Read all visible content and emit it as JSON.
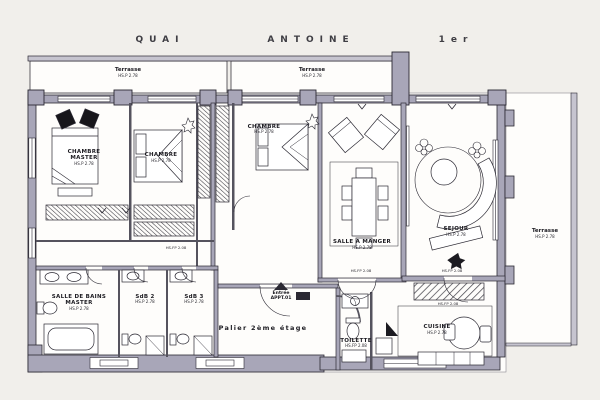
{
  "street": {
    "word1": "QUAI",
    "word2": "ANTOINE",
    "word3": "1er"
  },
  "rooms": {
    "terrasse_left": {
      "name": "Terrasse",
      "dim": "HS.P 2.78"
    },
    "terrasse_mid": {
      "name": "Terrasse",
      "dim": "HS.P 2.78"
    },
    "terrasse_right": {
      "name": "Terrasse",
      "dim": "HS.P 2.78"
    },
    "chambre_master": {
      "name_line1": "CHAMBRE",
      "name_line2": "MASTER",
      "dim": "HS.P 2.78"
    },
    "chambre_2": {
      "name": "CHAMBRE",
      "dim": "HS.P 2.78"
    },
    "chambre_3": {
      "name": "CHAMBRE",
      "dim": "HS.P 2.78"
    },
    "salle_a_manger": {
      "name": "SALLE A MANGER",
      "dim": "HS.P 2.78"
    },
    "sejour": {
      "name": "SEJOUR",
      "dim": "HS.P 2.78"
    },
    "salle_de_bains_master": {
      "name_line1": "SALLE DE BAINS",
      "name_line2": "MASTER",
      "dim": "HS.P 2.78"
    },
    "sdb_2": {
      "name": "SdB 2",
      "dim": "HS.P 2.78"
    },
    "sdb_3": {
      "name": "SdB 3",
      "dim": "HS.P 2.78"
    },
    "toilette": {
      "name": "TOILETTE",
      "dim": "HS.FP 2.08"
    },
    "cuisine": {
      "name": "CUISINE",
      "dim": "HS.P 2.78"
    },
    "palier": {
      "name": "Palier 2ème étage"
    },
    "entree": {
      "name_line1": "Entrée",
      "name_line2": "APPT.01"
    }
  },
  "annotations": {
    "corridor_height": "HS.FP 2.08",
    "dining_door_height": "HS.FP 2.08",
    "sejour_door_height": "HS.FP 2.08",
    "kitchen_soffit_height": "HS.FP 2.08"
  },
  "colors": {
    "wall_fill": "#a8a6b8",
    "wall_dark": "#55535e",
    "wall_outline": "#2b2933",
    "paper": "#f1efeb",
    "floor": "#fefdfb",
    "ink": "#1c1b21"
  }
}
